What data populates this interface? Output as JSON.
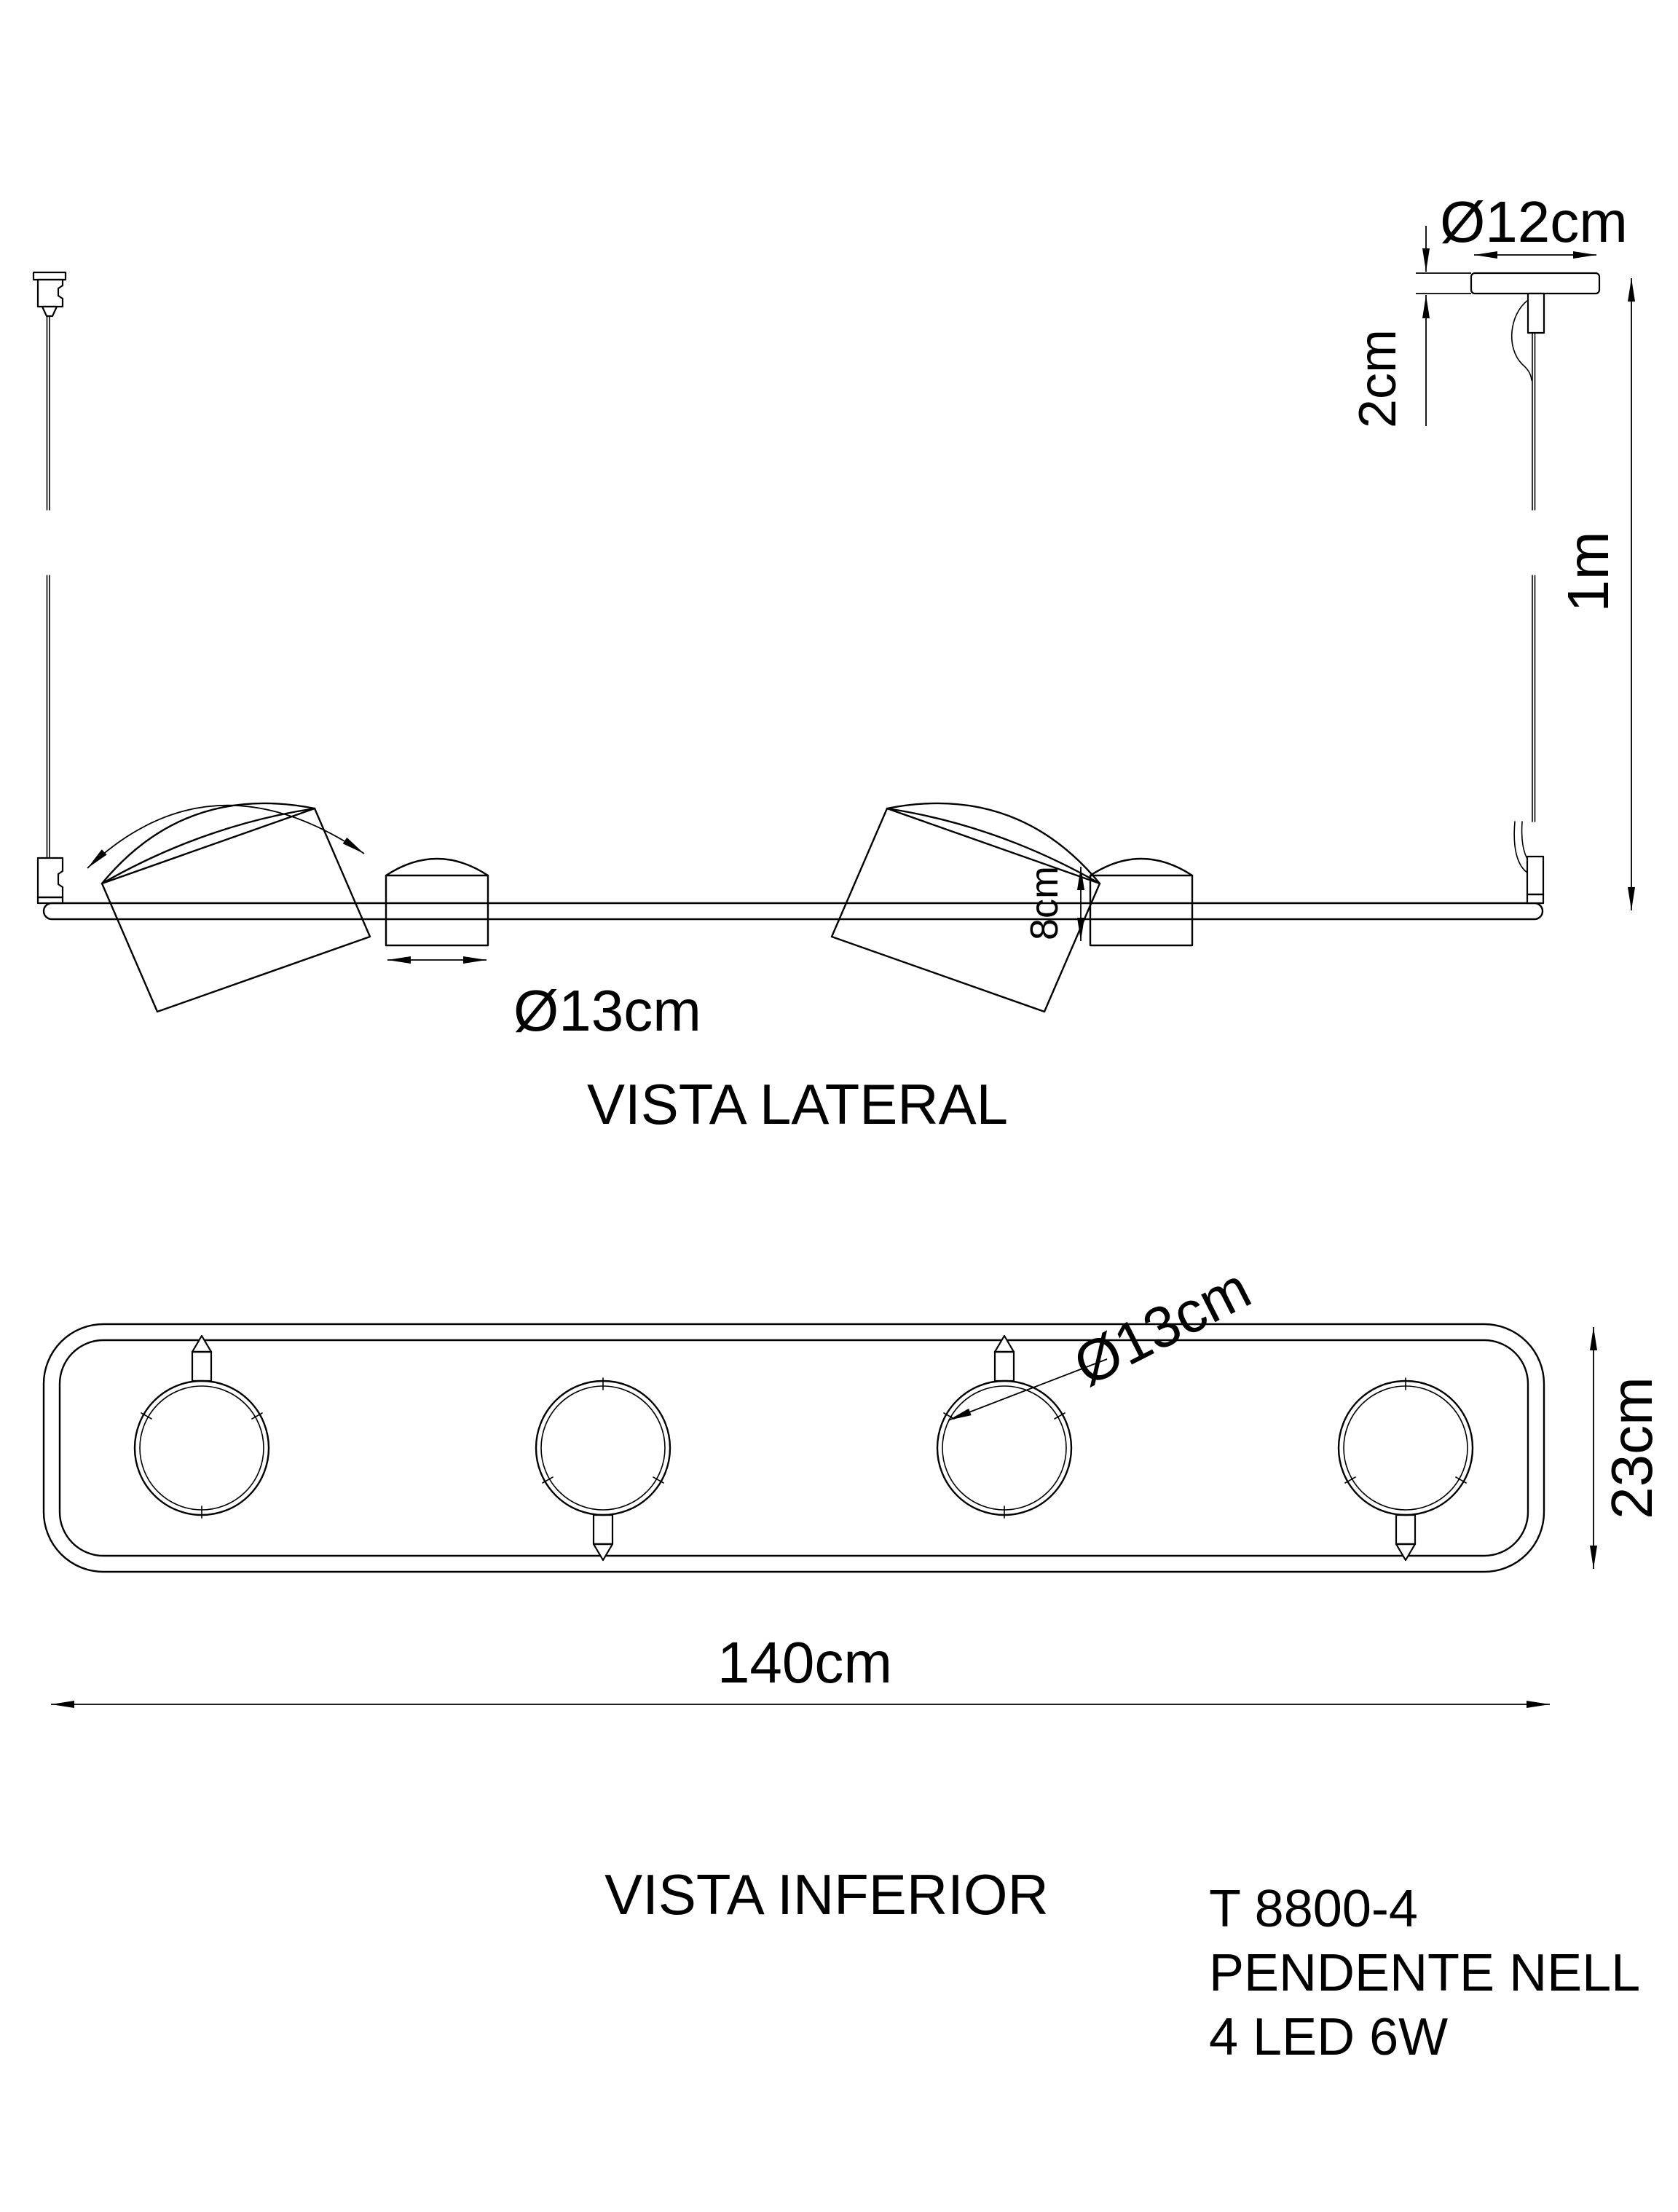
{
  "product": {
    "model": "T 8800-4",
    "name": "PENDENTE NELL",
    "lamps": "4 LED 6W"
  },
  "side_view": {
    "label": "VISTA LATERAL",
    "canopy_diameter": "Ø12cm",
    "canopy_thickness": "2cm",
    "suspension_length": "1m",
    "shade_diameter": "Ø13cm",
    "shade_height": "8cm"
  },
  "bottom_view": {
    "label": "VISTA INFERIOR",
    "shade_diameter": "Ø13cm",
    "body_depth": "23cm",
    "body_length": "140cm"
  },
  "colors": {
    "line": "#000000",
    "background": "#ffffff"
  }
}
